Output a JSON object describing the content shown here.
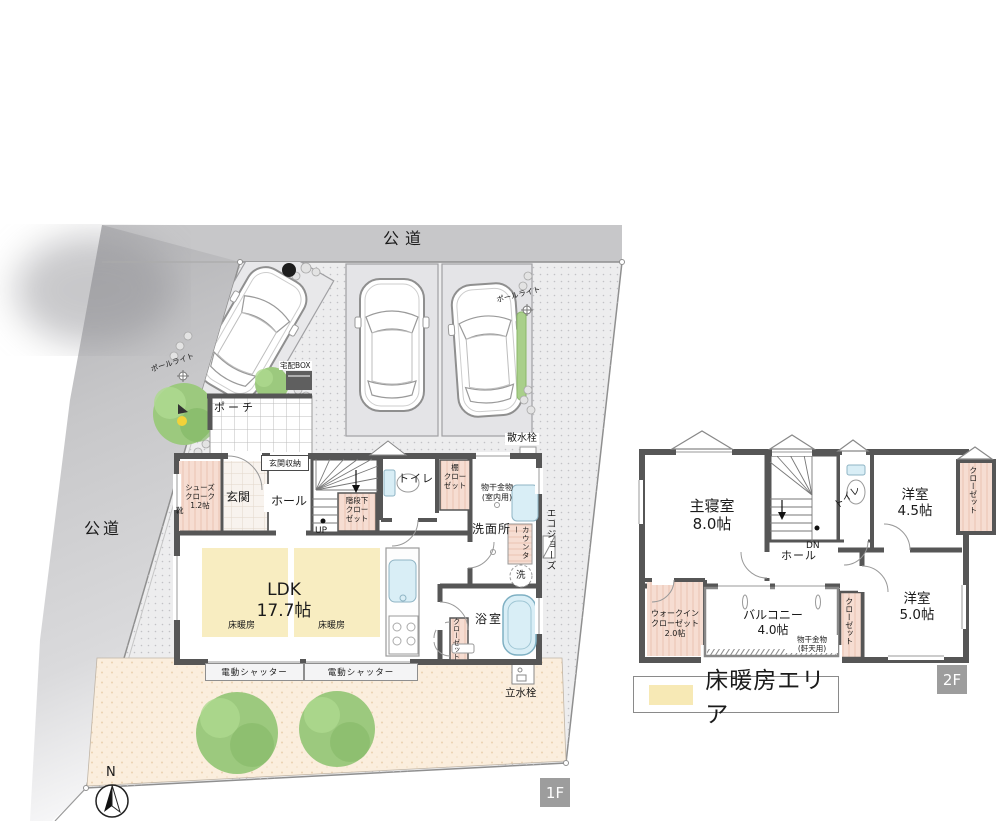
{
  "site": {
    "road_top": "公道",
    "road_left": "公道"
  },
  "floor1": {
    "tag": "1F",
    "labels": {
      "pole_light_left": "ポールライト",
      "pole_light_right": "ポールライト",
      "parcel_box": "宅配BOX",
      "porch": "ポーチ",
      "sprinkler_tap": "散水栓",
      "shoes_cloak": "シューズ\nクローク\n1.2帖",
      "shoe_shelf": "靴",
      "entrance": "玄関",
      "entrance_storage": "玄関収納",
      "hall": "ホール",
      "under_stair_closet": "階段下\nクロー\nゼット",
      "up": "UP",
      "toilet": "トイレ",
      "shelf_closet": "棚\nクロー\nゼット",
      "laundry_hook_indoor": "物干金物\n(室内用)",
      "washroom": "洗面所",
      "counter": "カウンター",
      "washer": "洗",
      "eco_jozu": "エコジョーズ",
      "ldk": "LDK\n17.7帖",
      "floor_heating_left": "床暖房",
      "floor_heating_right": "床暖房",
      "closet": "クローゼット",
      "bath": "浴室",
      "shutter_left": "電動シャッター",
      "shutter_right": "電動シャッター",
      "standing_tap": "立水栓"
    }
  },
  "floor2": {
    "tag": "2F",
    "labels": {
      "master_bedroom": "主寝室\n8.0帖",
      "dn": "DN",
      "hall": "ホール",
      "toilet": "トイレ",
      "bedroom_45": "洋室\n4.5帖",
      "closet_northeast": "クローゼット",
      "walk_in_closet": "ウォークイン\nクローゼット\n2.0帖",
      "balcony": "バルコニー\n4.0帖",
      "laundry_hook_eaves": "物干金物\n(軒天用)",
      "closet_middle": "クローゼット",
      "bedroom_50": "洋室\n5.0帖"
    }
  },
  "legend": {
    "label": "床暖房エリア",
    "swatch_color": "#f7e9b5"
  },
  "compass": {
    "label": "N"
  },
  "colors": {
    "wall": "#565656",
    "road": "#c7c7c9",
    "floor_heating": "#f8edc1",
    "closet_pink": "#f6ddd2",
    "garden": "#fbeedd",
    "water_blue": "#d9eef6",
    "tree_green": "#9cc97e",
    "tag_bg": "#9d9d9d"
  }
}
